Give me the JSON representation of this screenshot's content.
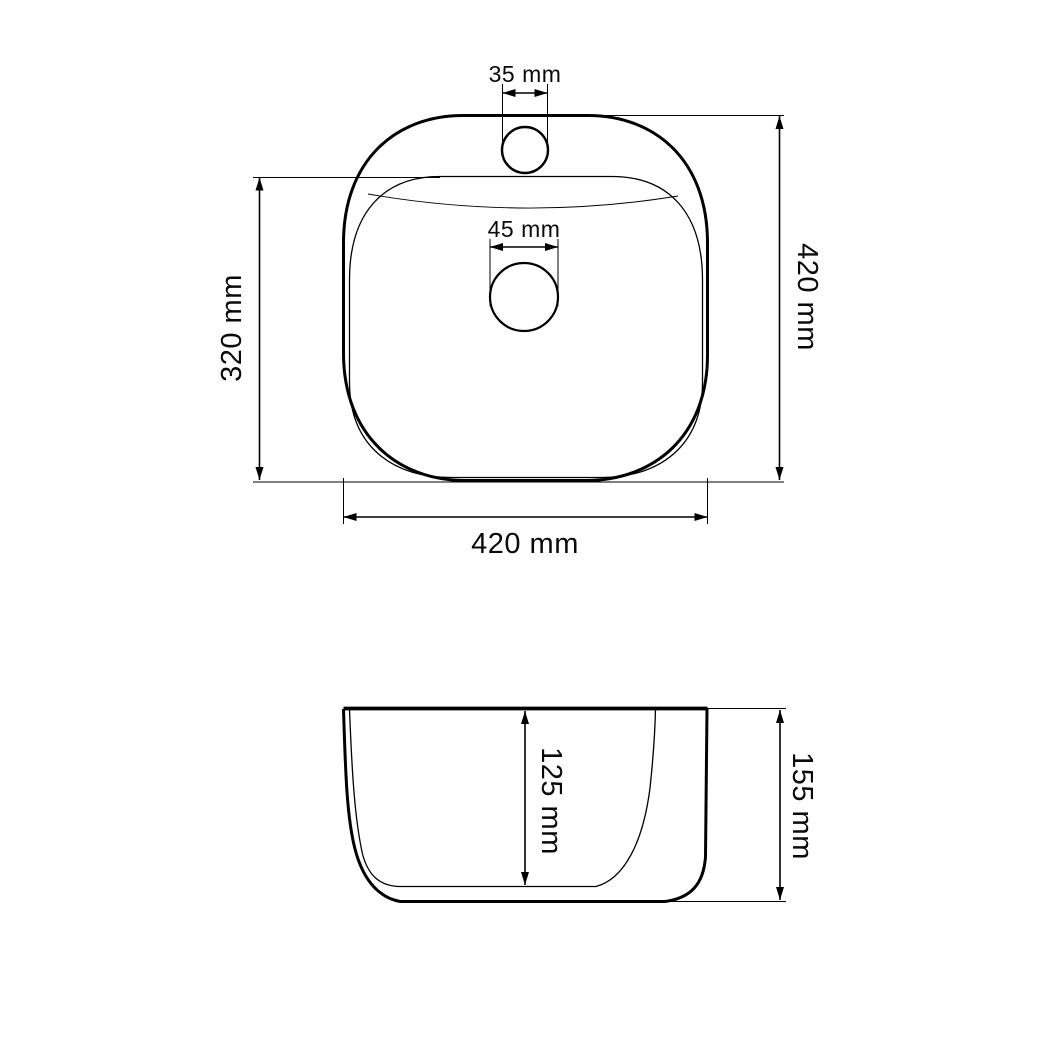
{
  "colors": {
    "background": "#ffffff",
    "line": "#000000"
  },
  "top_view": {
    "faucet_hole_diameter": "35 mm",
    "drain_hole_diameter": "45 mm",
    "basin_front_to_back": "320 mm",
    "overall_front_to_back": "420 mm",
    "overall_width": "420 mm"
  },
  "side_view": {
    "basin_depth": "125 mm",
    "overall_height": "155 mm"
  }
}
